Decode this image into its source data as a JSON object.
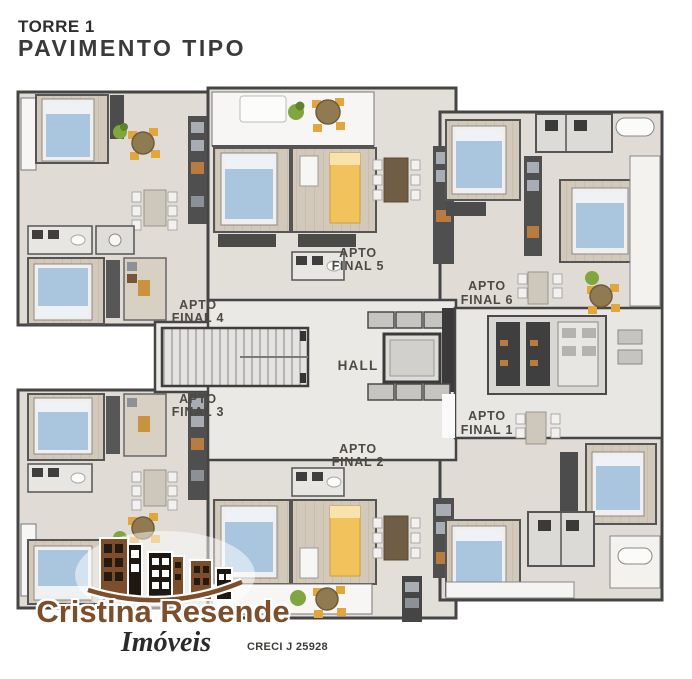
{
  "title": {
    "line1": "TORRE 1",
    "line2": "PAVIMENTO TIPO"
  },
  "floor_plan": {
    "hall_label": "HALL",
    "apartments": [
      {
        "name": "apto-final-1",
        "line1": "APTO",
        "line2": "FINAL 1"
      },
      {
        "name": "apto-final-2",
        "line1": "APTO",
        "line2": "FINAL 2"
      },
      {
        "name": "apto-final-3",
        "line1": "APTO",
        "line2": "FINAL 3"
      },
      {
        "name": "apto-final-4",
        "line1": "APTO",
        "line2": "FINAL 4"
      },
      {
        "name": "apto-final-5",
        "line1": "APTO",
        "line2": "FINAL 5"
      },
      {
        "name": "apto-final-6",
        "line1": "APTO",
        "line2": "FINAL 6"
      }
    ]
  },
  "logo": {
    "brand": "Cristina Resende",
    "tagline": "Imóveis",
    "license": "CRECI J 25928"
  },
  "colors": {
    "background": "#ffffff",
    "wall": "#454545",
    "slab": "#e0dcd5",
    "floor_wood": "#d3c9ba",
    "balcony_white": "#f7f6f4",
    "bed_blue": "#a9c6de",
    "bed_yellow": "#f2c35c",
    "chair_yellow": "#e2a63e",
    "table_brown": "#8f7a52",
    "plant_green": "#7fa63f",
    "counter_dark": "#4f4f4f",
    "accent_orange": "#b87c3e",
    "brand_brown": "#7d4e2c",
    "title_text": "#3a3a3a",
    "label_text": "#4d4a43"
  }
}
